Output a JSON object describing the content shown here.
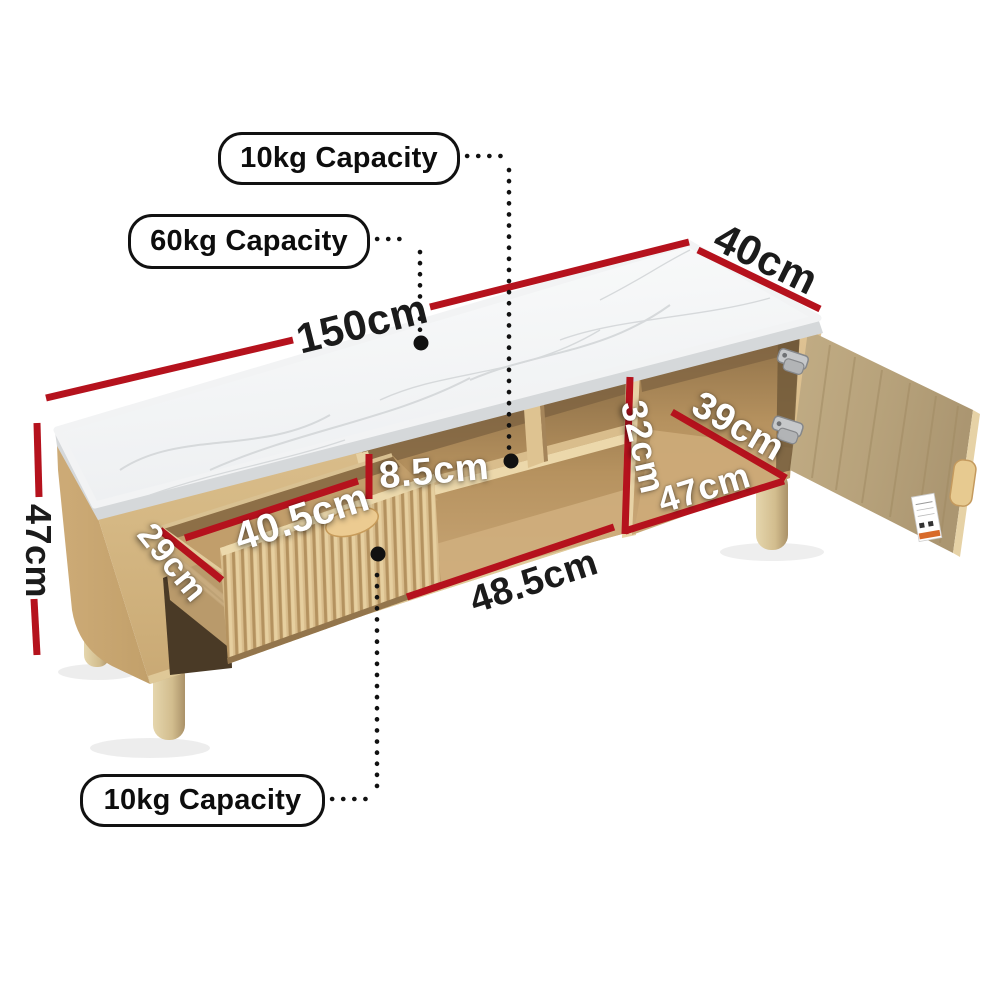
{
  "page": {
    "type": "product-dimension-diagram",
    "product": "TV entertainment unit with marble-look top, fluted drawer and cabinet door"
  },
  "capacity_labels": {
    "top": "10kg Capacity",
    "middle": "60kg Capacity",
    "bottom": "10kg Capacity"
  },
  "dimensions": {
    "length": "150cm",
    "depth": "40cm",
    "height": "47cm",
    "drawer_side": "29cm",
    "drawer_width": "40.5cm",
    "upper_shelf_height": "8.5cm",
    "door_inner_height": "32cm",
    "door_inner_depth": "39cm",
    "door_inner_width": "47cm",
    "middle_shelf_width": "48.5cm"
  },
  "colors": {
    "dimension_line": "#b5121d",
    "leader_dots": "#111111",
    "label_border": "#111111",
    "label_background": "#ffffff",
    "dark_text": "#1b1b1b",
    "light_text": "#ffffff",
    "wood": "#d8bc8b",
    "wood_dark": "#b08c58",
    "marble": "#f7f8f9"
  }
}
